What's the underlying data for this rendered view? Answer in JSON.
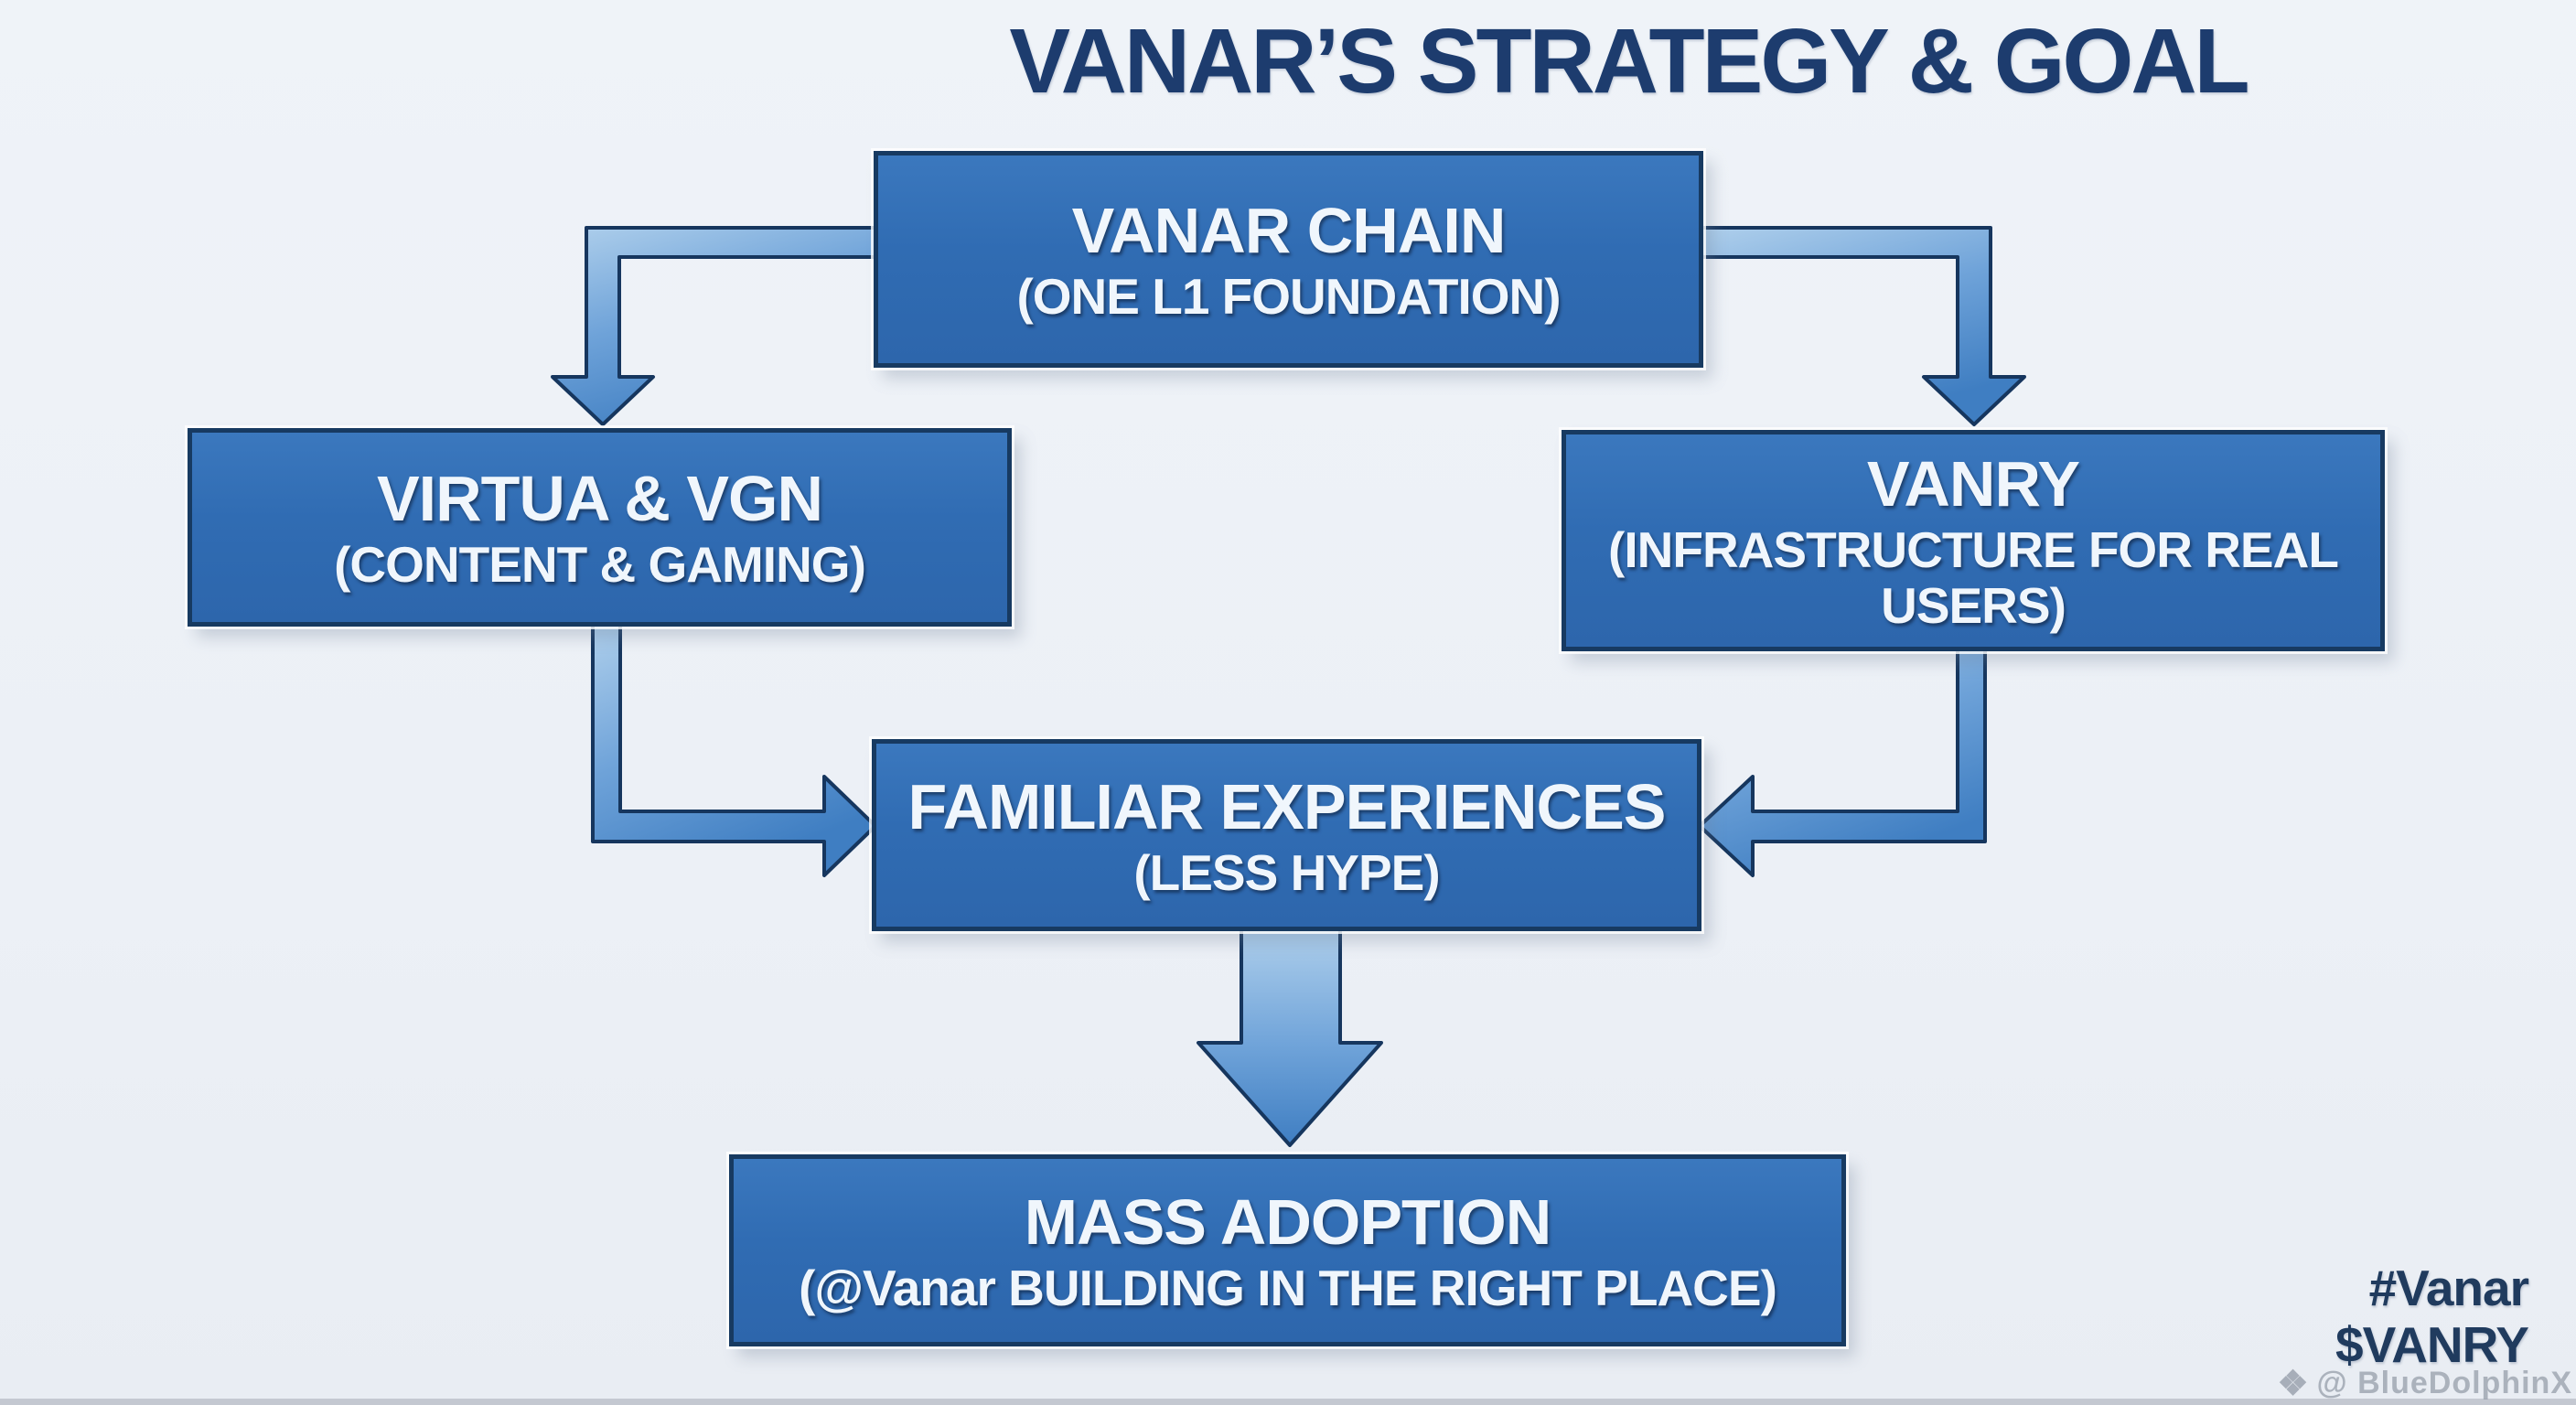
{
  "title": "VANAR’S STRATEGY & GOAL",
  "boxes": {
    "chain": {
      "main": "VANAR CHAIN",
      "sub": "(ONE L1 FOUNDATION)"
    },
    "virtua": {
      "main": "VIRTUA & VGN",
      "sub": "(CONTENT & GAMING)"
    },
    "vanry": {
      "main": "VANRY",
      "sub": "(INFRASTRUCTURE FOR REAL USERS)"
    },
    "familiar": {
      "main": "FAMILIAR EXPERIENCES",
      "sub": "(LESS HYPE)"
    },
    "adoption": {
      "main": "MASS ADOPTION",
      "sub": "(@Vanar BUILDING IN THE RIGHT PLACE)"
    }
  },
  "footer": {
    "hashtag": "#Vanar",
    "ticker": "$VANRY",
    "watermark": "@ BlueDolphinX",
    "watermark_icon": "diamond-logo",
    "watermark_icon_glyph": "❖"
  },
  "colors": {
    "background": "#ecf0f6",
    "box_fill": "#306cb3",
    "box_border": "#173a61",
    "box_text": "#f0f6fc",
    "arrow_fill_light": "#b0d0ec",
    "arrow_fill_dark": "#3f7ec2",
    "arrow_outline": "#16365e",
    "title_text": "#1d3c6e",
    "footer_text": "#203b5e",
    "watermark_text": "#969daa"
  }
}
